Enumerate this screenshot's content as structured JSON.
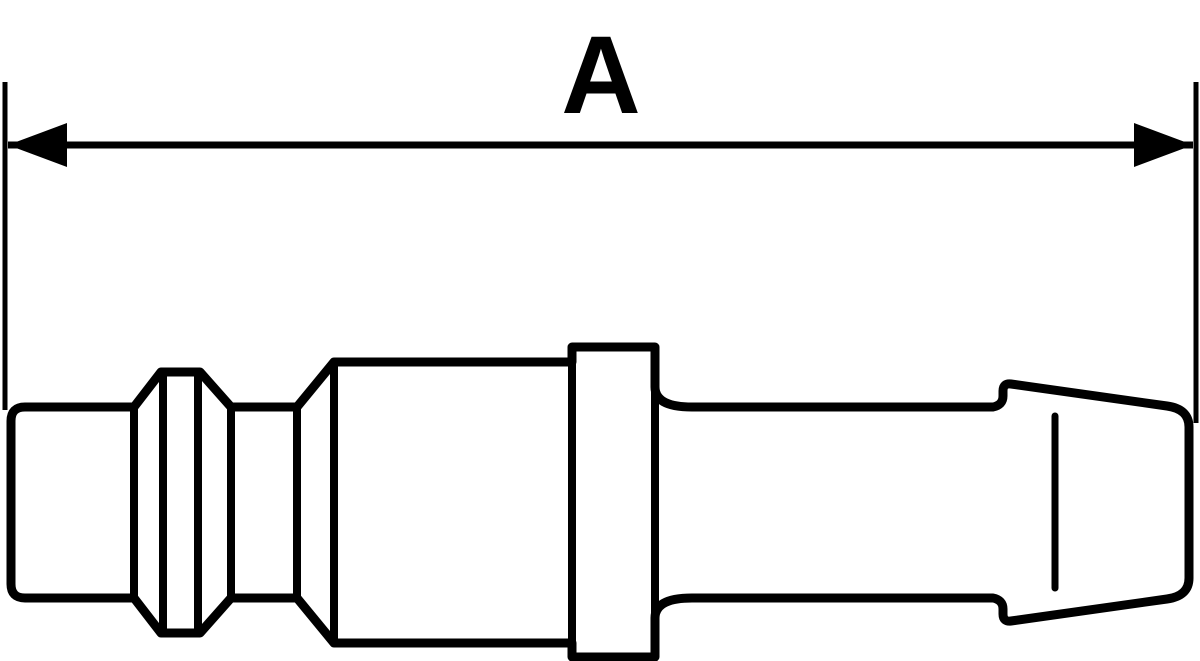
{
  "drawing": {
    "type": "technical-line-drawing",
    "subject": "pneumatic quick-coupling plug with hose barb stem, side profile view",
    "background_color": "#ffffff",
    "line_color": "#000000",
    "dimension": {
      "label": "A",
      "measures": "overall length"
    }
  },
  "geometry": {
    "viewbox": "0 0 1200 661",
    "outline_path": "M 11 421 Q 11 407 25 407 L 134 407 L 161 372 L 200 372 L 231 407 L 297 407 L 334 362 L 572 362 L 572 347 L 655 347 L 655 387 Q 655 407 692 407 L 993 407 Q 1003 405 1003 396 L 1003 391 Q 1003 383 1011 384 L 1167 406 Q 1189 409 1189 427 L 1189 578 Q 1189 596 1167 599 L 1011 621 Q 1003 622 1003 614 L 1003 609 Q 1003 600 993 598 L 692 598 Q 655 598 655 618 L 655 657 L 572 657 L 572 643 L 334 643 L 297 598 L 231 598 L 200 633 L 161 633 L 134 598 L 25 598 Q 11 598 11 584 Z",
    "edges": {
      "tip_cone_edge": "M 134 407 L 134 598",
      "ridge_left_face": "M 163 372 L 163 633",
      "ridge_right_face": "M 198 372 L 198 633",
      "groove_left_edge": "M 231 407 L 231 598",
      "groove_right_edge": "M 297 407 L 297 598",
      "body_left_face": "M 334 362 L 334 643",
      "collar_left_face": "M 572 347 L 572 657",
      "collar_right_face": "M 655 347 L 655 657"
    },
    "barb_highlight_line": "M 1055 416 L 1055 588",
    "extension_line_left": "M 5 82 L 5 410",
    "extension_line_right": "M 1196 82 L 1196 423",
    "dimension_line": "M 8 145 L 1193 145",
    "arrowhead_left_points": "8,145 67,123 67,167",
    "arrowhead_right_points": "1193,145 1134,123 1134,167",
    "label_x": "601",
    "label_y": "113"
  }
}
